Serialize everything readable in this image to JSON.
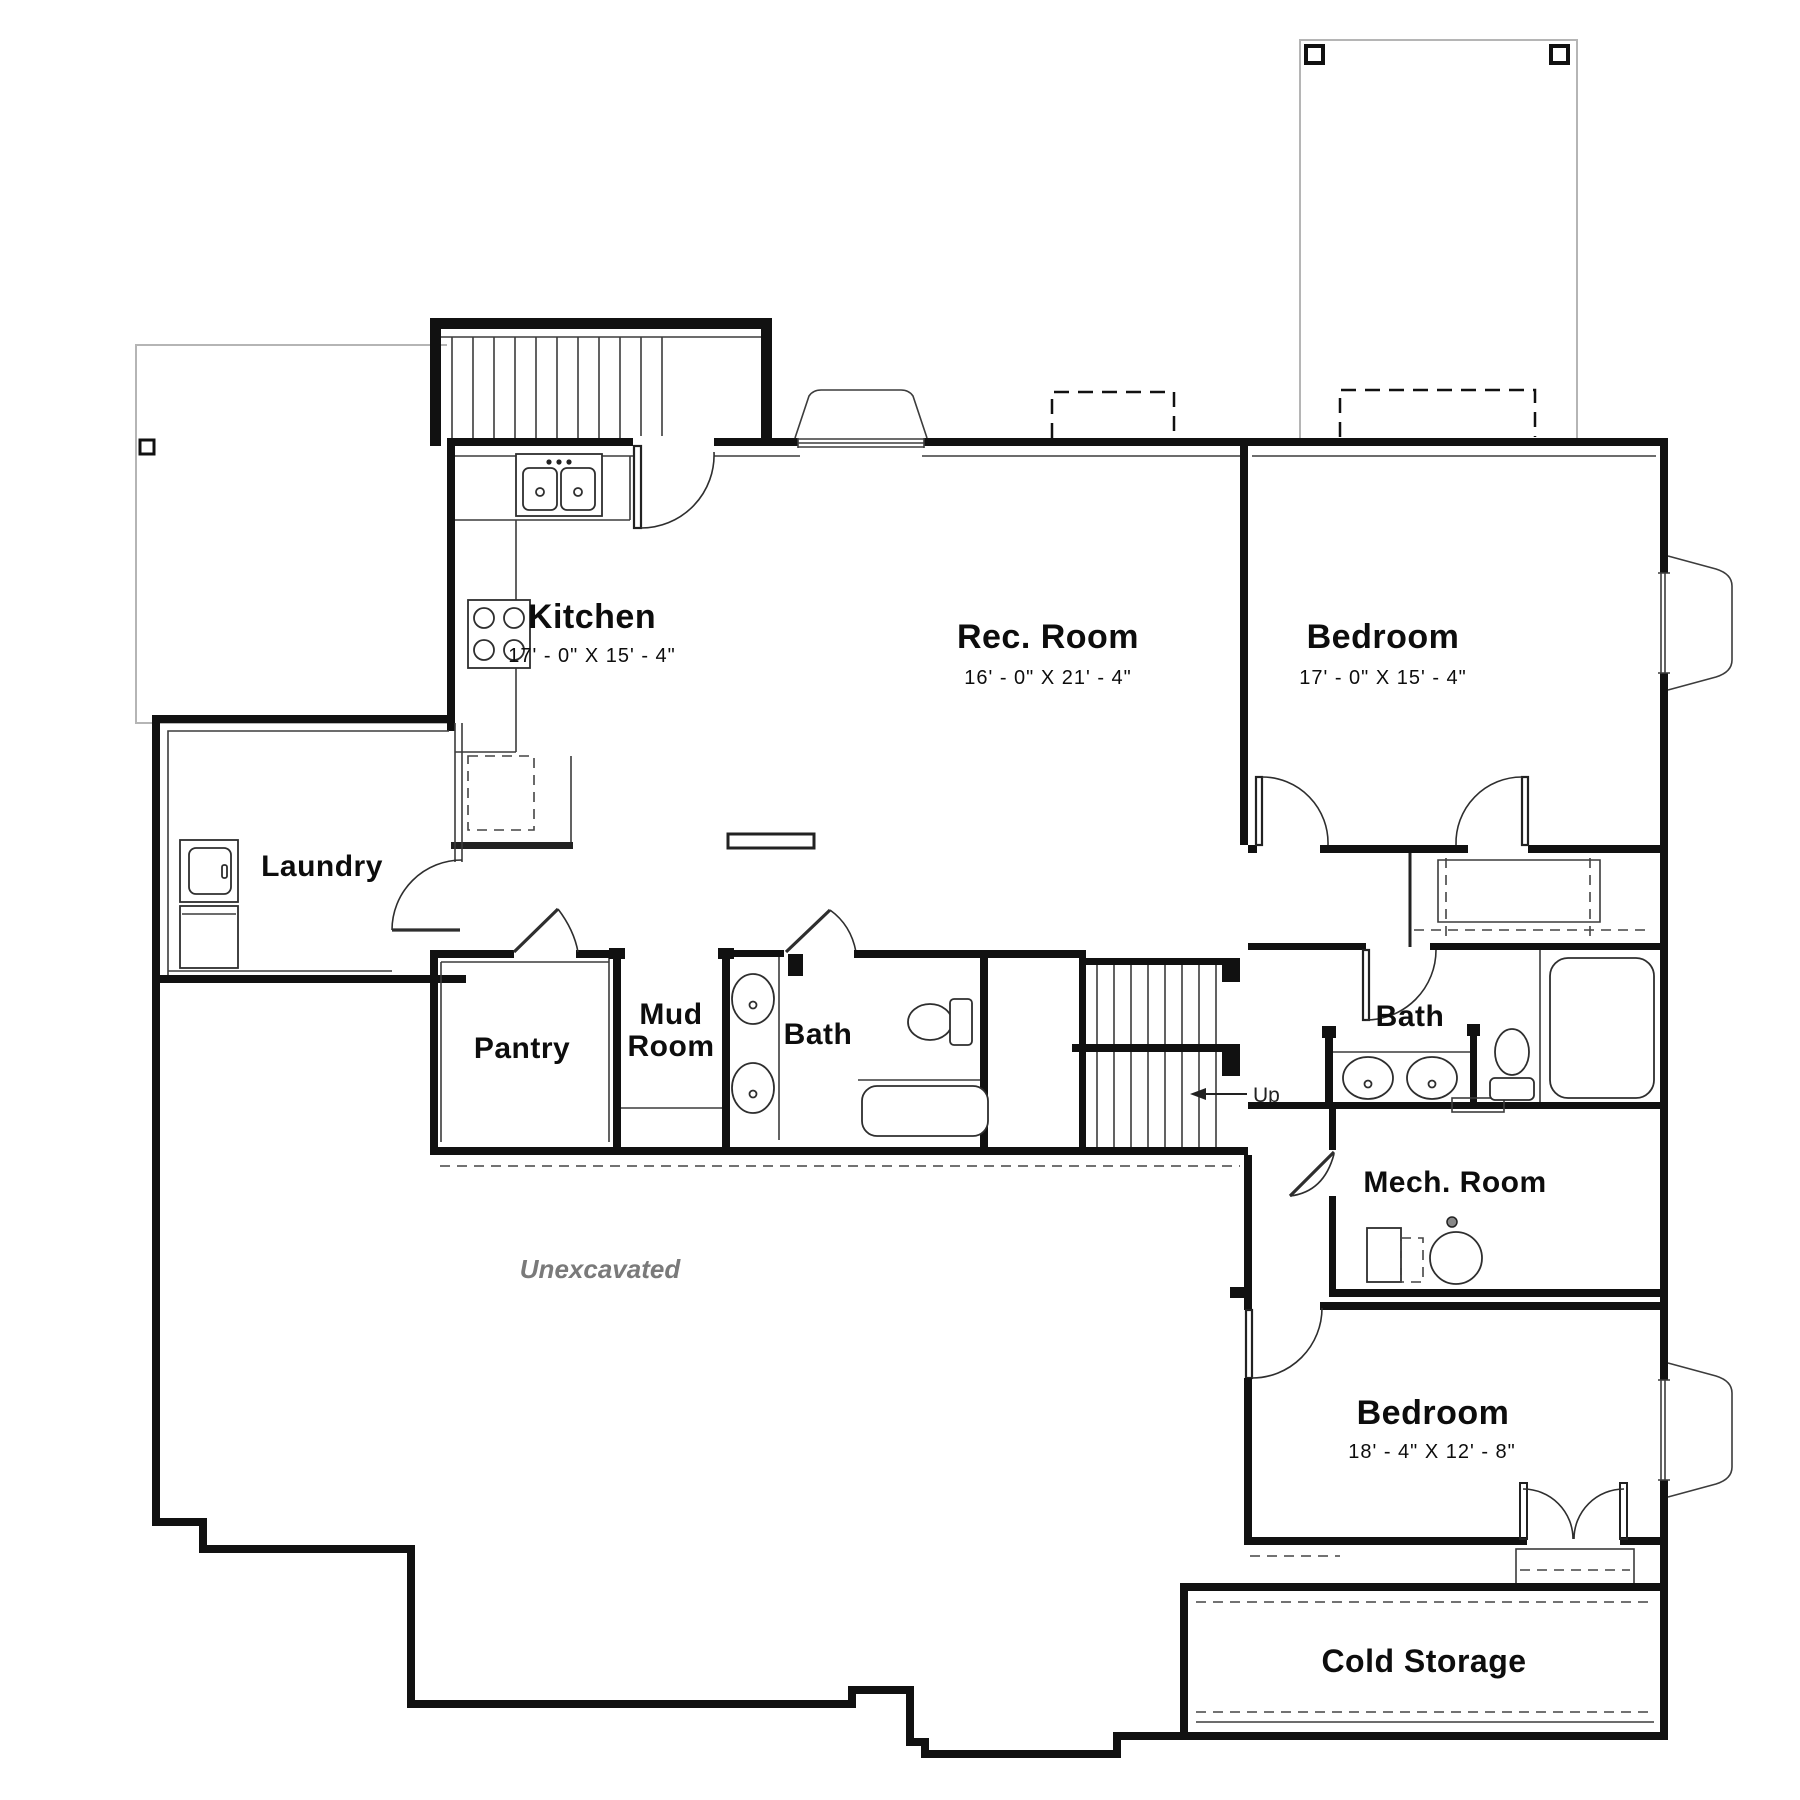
{
  "plan": {
    "title": "Basement Floor Plan",
    "rooms": {
      "kitchen": {
        "label": "Kitchen",
        "dims": "17' - 0\"  X  15' - 4\""
      },
      "rec_room": {
        "label": "Rec. Room",
        "dims": "16' - 0\"  X  21' - 4\""
      },
      "bedroom_ne": {
        "label": "Bedroom",
        "dims": "17' - 0\"  X  15' - 4\""
      },
      "laundry": {
        "label": "Laundry"
      },
      "pantry": {
        "label": "Pantry"
      },
      "mud_room": {
        "line1": "Mud",
        "line2": "Room"
      },
      "bath_main": {
        "label": "Bath"
      },
      "bath_two": {
        "label": "Bath"
      },
      "mech_room": {
        "label": "Mech. Room"
      },
      "bedroom_s": {
        "label": "Bedroom",
        "dims": "18' - 4\"  X  12' - 8\""
      },
      "cold_storage": {
        "label": "Cold Storage"
      },
      "unexcavated": {
        "label": "Unexcavated"
      }
    },
    "annotations": {
      "up": "Up"
    },
    "colors": {
      "wall": "#111111",
      "overhead": "#b5b5b5",
      "note_text": "#7a7a7a"
    }
  }
}
